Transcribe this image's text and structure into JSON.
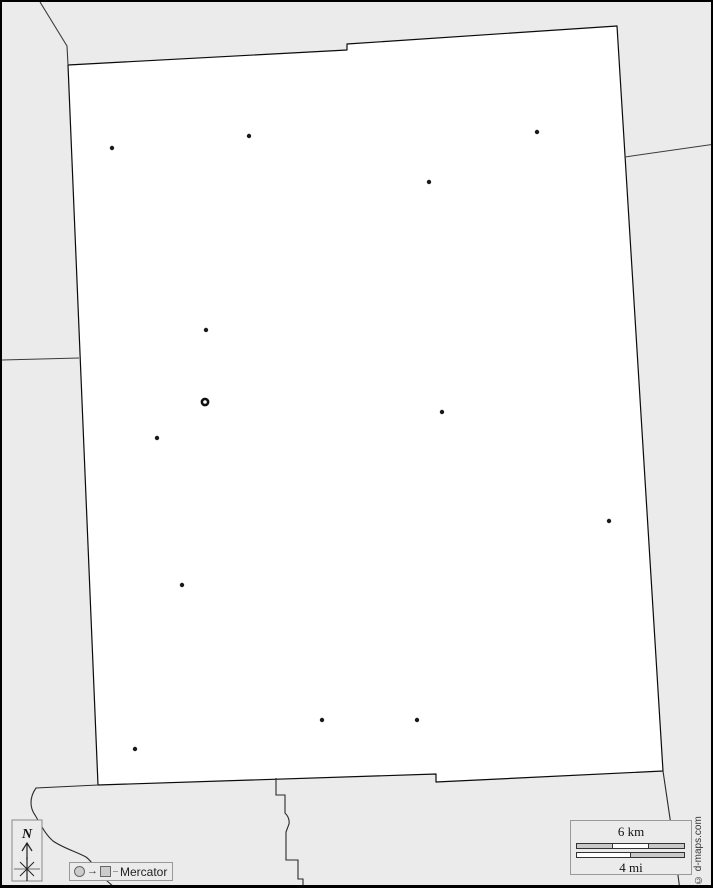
{
  "map": {
    "background_color": "#ebebeb",
    "region_fill": "#ffffff",
    "border_color": "#0a0a0a",
    "neighbor_line_color": "#3a3a3a",
    "town_dot_color": "#1a1a1a",
    "towns": [
      {
        "x": 110,
        "y": 146
      },
      {
        "x": 247,
        "y": 134
      },
      {
        "x": 535,
        "y": 130
      },
      {
        "x": 427,
        "y": 180
      },
      {
        "x": 204,
        "y": 328
      },
      {
        "x": 155,
        "y": 436
      },
      {
        "x": 440,
        "y": 410
      },
      {
        "x": 607,
        "y": 519
      },
      {
        "x": 180,
        "y": 583
      },
      {
        "x": 320,
        "y": 718
      },
      {
        "x": 415,
        "y": 718
      },
      {
        "x": 133,
        "y": 747
      }
    ],
    "county_seat": {
      "x": 203,
      "y": 400
    }
  },
  "compass": {
    "label": "N"
  },
  "legend": {
    "town_symbol": "circle-icon",
    "seat_symbol": "square-icon",
    "arrow": "→",
    "label": "Mercator"
  },
  "scale_bar": {
    "km_label": "6 km",
    "mi_label": "4 mi"
  },
  "credit": {
    "text": "© d-maps.com"
  }
}
